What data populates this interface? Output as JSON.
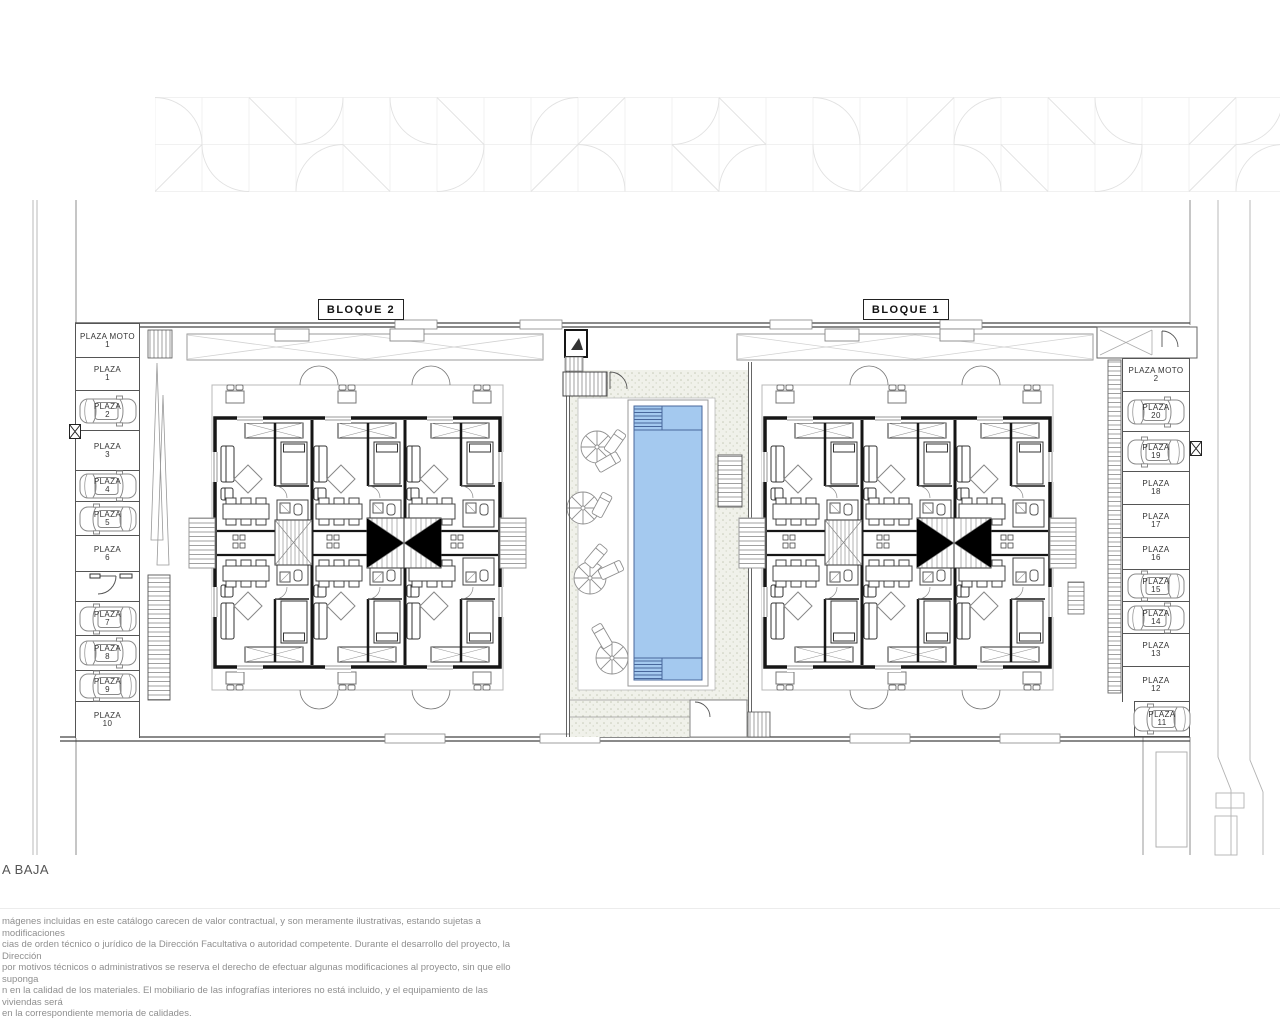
{
  "page": {
    "floor_label": "A BAJA"
  },
  "blocks": {
    "block2": "BLOQUE 2",
    "block1": "BLOQUE 1"
  },
  "parking": {
    "left": [
      {
        "name": "PLAZA MOTO",
        "num": "1",
        "car": false
      },
      {
        "name": "PLAZA",
        "num": "1",
        "car": false
      },
      {
        "name": "PLAZA",
        "num": "2",
        "car": true
      },
      {
        "name": "PLAZA",
        "num": "3",
        "car": false
      },
      {
        "name": "PLAZA",
        "num": "4",
        "car": true
      },
      {
        "name": "PLAZA",
        "num": "5",
        "car": true
      },
      {
        "name": "PLAZA",
        "num": "6",
        "car": false
      },
      {
        "name": "PLAZA",
        "num": "7",
        "car": true
      },
      {
        "name": "PLAZA",
        "num": "8",
        "car": true
      },
      {
        "name": "PLAZA",
        "num": "9",
        "car": true
      },
      {
        "name": "PLAZA",
        "num": "10",
        "car": false
      }
    ],
    "right": [
      {
        "name": "PLAZA MOTO",
        "num": "2",
        "car": false
      },
      {
        "name": "PLAZA",
        "num": "20",
        "car": true
      },
      {
        "name": "PLAZA",
        "num": "19",
        "car": true
      },
      {
        "name": "PLAZA",
        "num": "18",
        "car": false
      },
      {
        "name": "PLAZA",
        "num": "17",
        "car": false
      },
      {
        "name": "PLAZA",
        "num": "16",
        "car": false
      },
      {
        "name": "PLAZA",
        "num": "15",
        "car": true
      },
      {
        "name": "PLAZA",
        "num": "14",
        "car": true
      },
      {
        "name": "PLAZA",
        "num": "13",
        "car": false
      },
      {
        "name": "PLAZA",
        "num": "12",
        "car": false
      },
      {
        "name": "PLAZA",
        "num": "11",
        "car": true
      }
    ]
  },
  "disclaimer": {
    "lines": [
      "mágenes incluidas en este catálogo carecen de valor contractual, y son meramente ilustrativas, estando sujetas a modificaciones",
      "cias de  orden técnico o jurídico de la Dirección Facultativa o autoridad competente. Durante el desarrollo del proyecto, la Dirección",
      "por motivos técnicos o administrativos se reserva el derecho de efectuar algunas modificaciones al proyecto, sin que ello suponga",
      "n  en la calidad de los materiales. El mobiliario de las infografías interiores no está incluido, y el equipamiento de las viviendas será",
      "en la correspondiente memoria de calidades."
    ]
  },
  "colors": {
    "pool_water": "#a4c9ef",
    "pool_lines": "#48679b",
    "stipple_bg": "#f0f1ea"
  }
}
